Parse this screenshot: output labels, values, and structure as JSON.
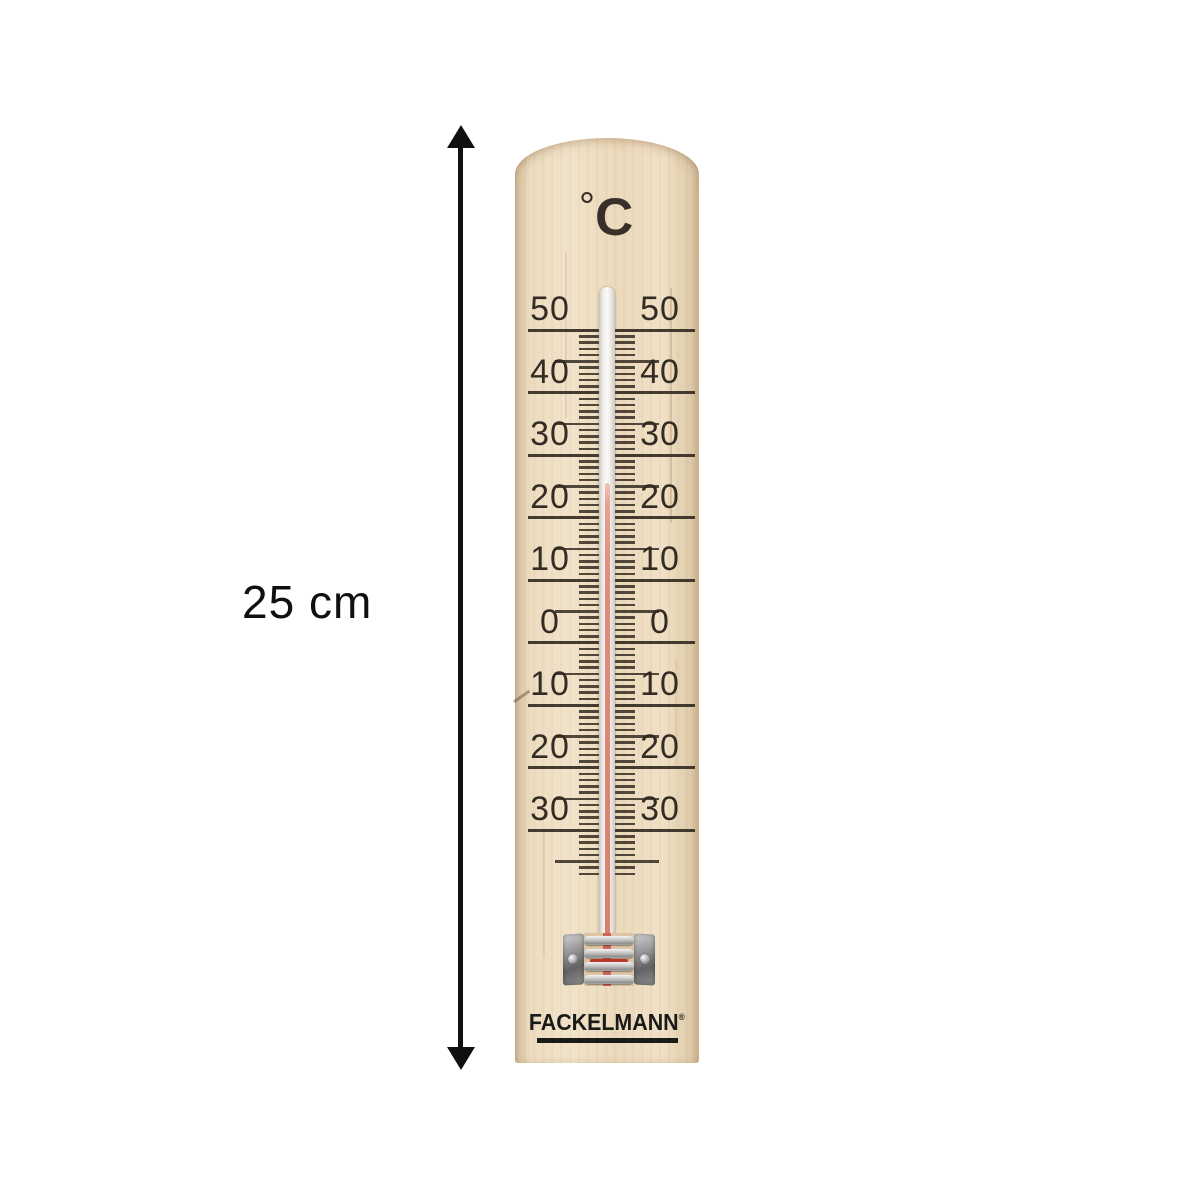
{
  "annotation": {
    "length_label": "25 cm"
  },
  "thermometer": {
    "unit": {
      "degree_symbol": "°",
      "letter": "C"
    },
    "brand": {
      "name": "FACKELMANN",
      "registered": "®"
    },
    "scale": {
      "unit": "°C",
      "top_deg": 50,
      "majors": [
        {
          "value": 50,
          "label": "50"
        },
        {
          "value": 40,
          "label": "40"
        },
        {
          "value": 30,
          "label": "30"
        },
        {
          "value": 20,
          "label": "20"
        },
        {
          "value": 10,
          "label": "10"
        },
        {
          "value": 0,
          "label": "0"
        },
        {
          "value": -10,
          "label": "10"
        },
        {
          "value": -20,
          "label": "20"
        },
        {
          "value": -30,
          "label": "30"
        }
      ],
      "minor_tick_step_deg": 1,
      "medium_tick_step_deg": 5,
      "minor_ticks_to_deg": -37
    },
    "reading": {
      "liquid_top_deg_c": 25.5,
      "liquid_color": "#df8d7e"
    },
    "colors": {
      "wood": "#ecd9bc",
      "print": "#332c24",
      "bracket_metal": "#a0a0a0",
      "arrow": "#101010"
    }
  }
}
